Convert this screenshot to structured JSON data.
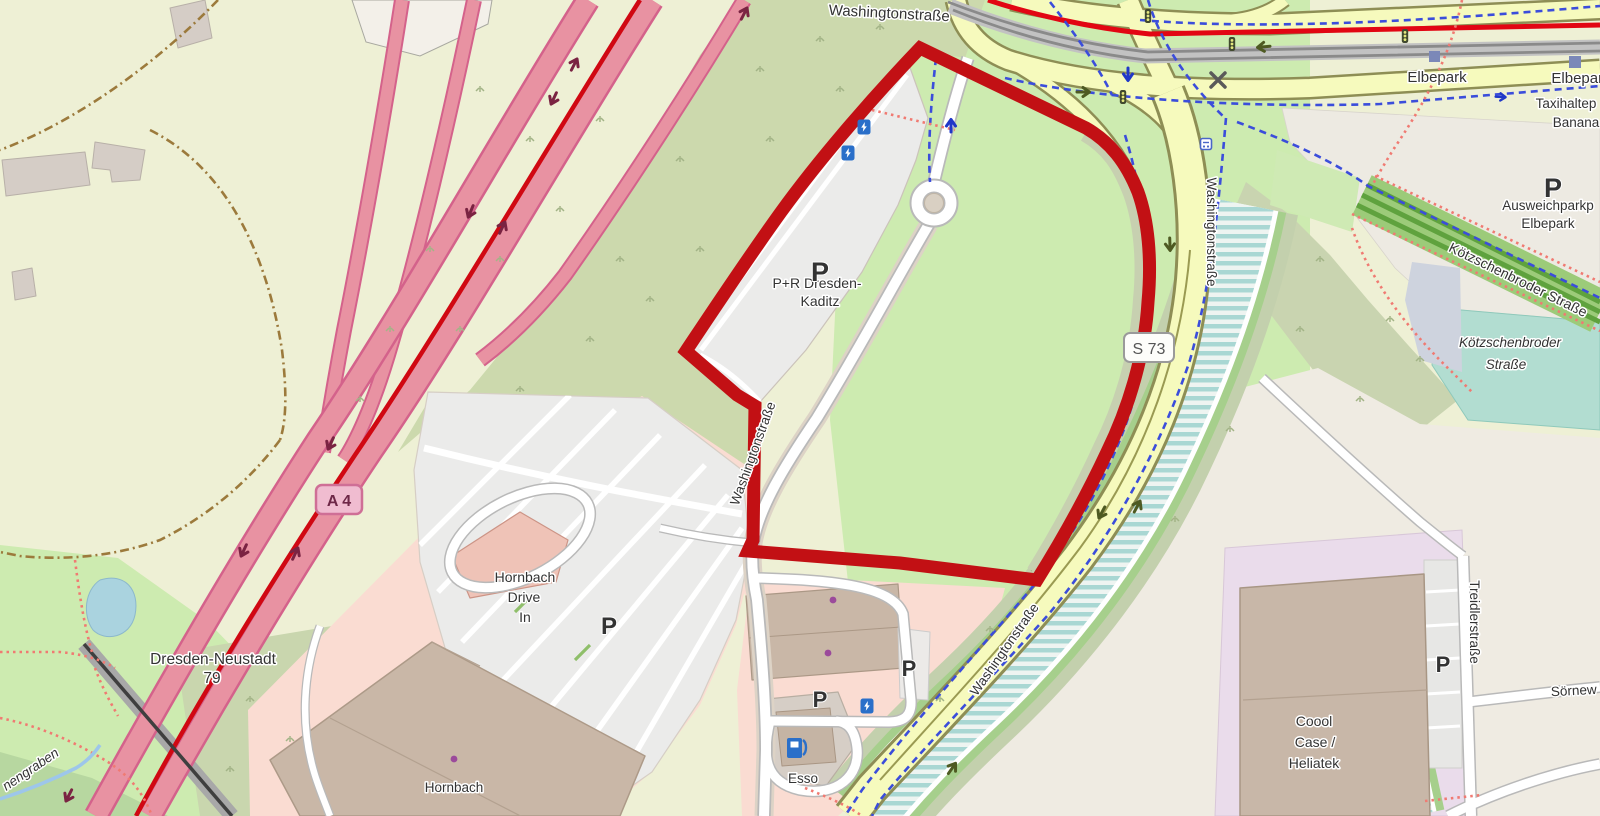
{
  "map": {
    "highlight": {
      "color": "#c21014",
      "shape": "area-boundary-polygon"
    },
    "labels": {
      "washingtonstrasse": "Washingtonstraße",
      "elbepark": "Elbepark",
      "taxihalteplatz_truncated": "Taxihaltep",
      "banana_truncated": "Banana",
      "ausweichparkplatz_truncated": "Ausweichparkp",
      "koetzschenbroder_strasse": "Kötzschenbroder Straße",
      "koetzschenbroder_line1": "Kötzschenbroder",
      "koetzschenbroder_line2": "Straße",
      "pr_line1": "P+R Dresden-",
      "pr_line2": "Kaditz",
      "dresden_neustadt": "Dresden-Neustadt",
      "exit_number": "79",
      "nengraben_truncated": "nengraben",
      "hornbach_drive_in_1": "Hornbach",
      "hornbach_drive_in_2": "Drive",
      "hornbach_drive_in_3": "In",
      "hornbach": "Hornbach",
      "coool_1": "Coool",
      "coool_2": "Case /",
      "coool_3": "Heliatek",
      "treidlerstrasse": "Treidlerstraße",
      "soernewitzer_truncated": "Sörnew",
      "esso": "Esso"
    },
    "shields": {
      "a4": "A 4",
      "s73": "S 73"
    },
    "icons": {
      "parking_label": "P",
      "charging_station": "lightning-bolt",
      "fuel_station": "fuel-pump",
      "traffic_light": "traffic-signal",
      "level_crossing": "x-cross",
      "bus_stop": "bus-stop",
      "tram_stop": "tram-platform-square",
      "poi_dot": "purple-dot"
    },
    "colors": {
      "highlight_red": "#c21014",
      "tram_route_red": "#e20613",
      "motorway_pink": "#e892a2",
      "motorway_casing": "#d4628b",
      "secondary_road_yellow": "#f6fabd",
      "road_casing_olive": "#8e8e55",
      "grass_green": "#cdebb0",
      "scrub_green": "#ccd9ad",
      "farmland_pale": "#eef0d5",
      "water_blue": "#aad3df",
      "canal_stripe": "#a9d7d3",
      "teal_area": "#b2ddd1",
      "retail_pink": "#fadcd2",
      "industrial_lavender": "#eadceb",
      "building_brown": "#c9b7a7",
      "parking_gray": "#ebebea",
      "beige_area": "#efebe2",
      "transit_label_blue": "#4c5a9a",
      "poi_label_azure": "#2a7cd1",
      "cycleway_blue": "#3b4ddb",
      "footpath_red": "#f07a72",
      "shop_purple": "#a848a8"
    }
  }
}
